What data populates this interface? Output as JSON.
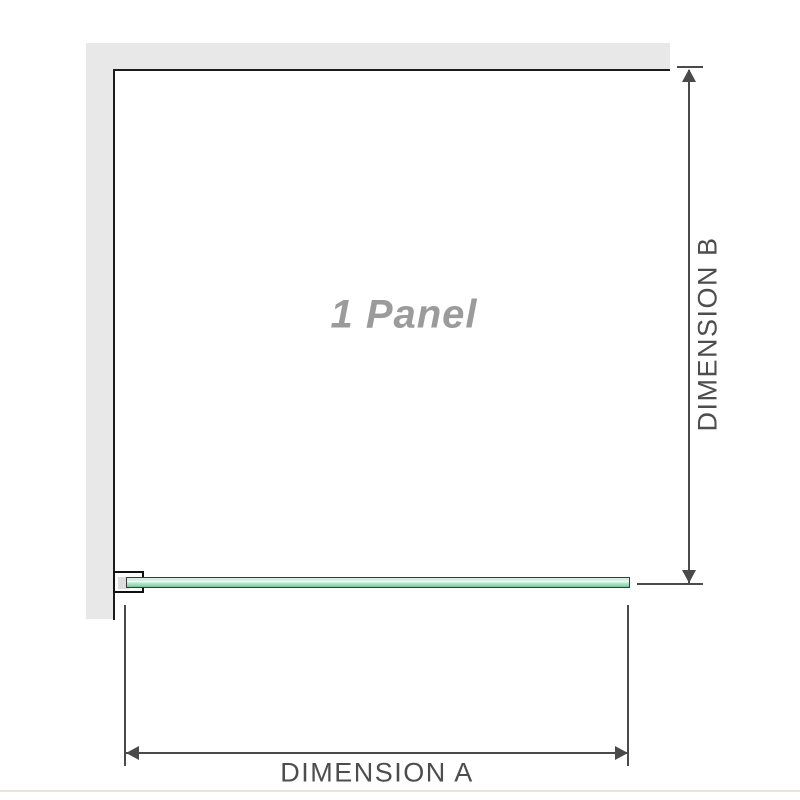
{
  "diagram": {
    "panel_label": "1 Panel",
    "dimension_a": {
      "label": "DIMENSION A"
    },
    "dimension_b": {
      "label": "DIMENSION B"
    }
  },
  "colors": {
    "wall_fill": "#e8e8e8",
    "wall_edge": "#1c1c1c",
    "dimension_line": "#4a4a4a",
    "dimension_text": "#4d4d4d",
    "panel_label_gray": "#9b9b9b",
    "glass_light": "#cdeedd",
    "glass_dark": "#79c898",
    "glass_outline": "#3a3a3a",
    "bracket_border": "#111111",
    "bracket_insert": "#dcdcdc",
    "bottom_divider": "#e9e5dc"
  }
}
